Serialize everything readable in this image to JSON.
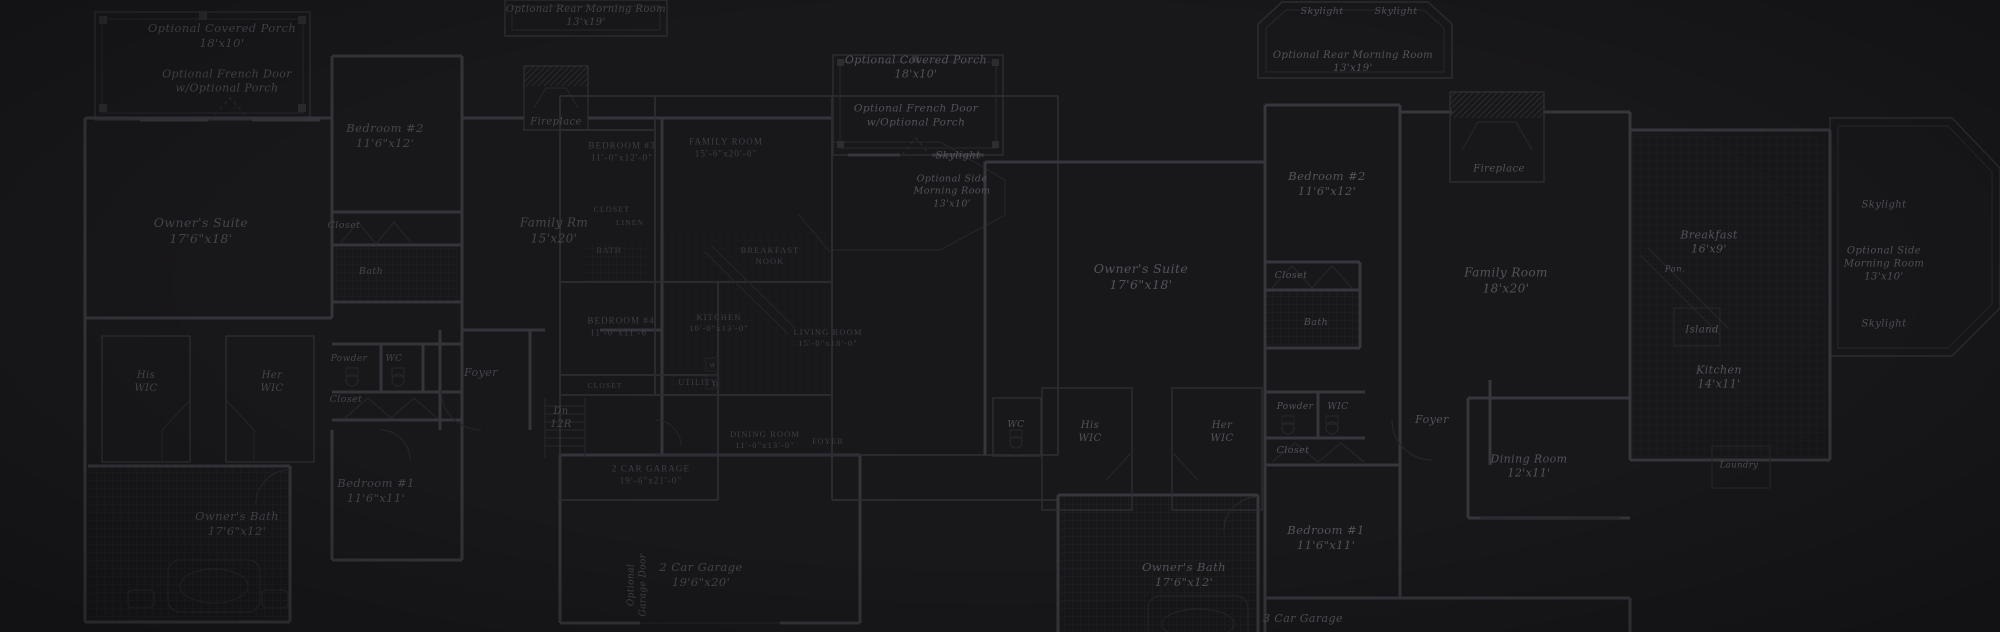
{
  "theme": {
    "background": "#18171a",
    "wall": "#36363c",
    "wall_soft": "#2e2e33",
    "thin": "#26262b",
    "hatch": "#222227",
    "hatch_dim": "#1e1e23",
    "text": "#45454d",
    "text_bright": "#53535c",
    "text_caps": "#3e3e47"
  },
  "description": "Darkened blueprint collage of overlapping residential floor plans",
  "labels": [
    {
      "name": "label-optional-covered-porch-left",
      "plan": "left",
      "style": "i",
      "x": 222,
      "y": 36,
      "size": 11.5,
      "text": "Optional Covered Porch\n18'x10'"
    },
    {
      "name": "label-optional-french-door-left",
      "plan": "left",
      "style": "i",
      "x": 227,
      "y": 82,
      "size": 11,
      "text": "Optional French Door\nw/Optional Porch"
    },
    {
      "name": "label-bedroom-2-left",
      "plan": "left",
      "style": "i",
      "x": 385,
      "y": 136,
      "size": 11.5,
      "text": "Bedroom #2\n11'6\"x12'"
    },
    {
      "name": "label-fireplace-left",
      "plan": "left",
      "style": "i",
      "x": 556,
      "y": 122,
      "size": 10,
      "text": "Fireplace"
    },
    {
      "name": "label-owners-suite-left",
      "plan": "left",
      "style": "i",
      "x": 201,
      "y": 231,
      "size": 12.5,
      "text": "Owner's Suite\n17'6\"x18'"
    },
    {
      "name": "label-closet-bed2-left",
      "plan": "left",
      "style": "i",
      "x": 344,
      "y": 226,
      "size": 9.5,
      "text": "Closet"
    },
    {
      "name": "label-bath-left",
      "plan": "left",
      "style": "i",
      "x": 371,
      "y": 272,
      "size": 9.5,
      "text": "Bath"
    },
    {
      "name": "label-his-wic-left",
      "plan": "left",
      "style": "i",
      "x": 146,
      "y": 382,
      "size": 10,
      "text": "His\nWIC"
    },
    {
      "name": "label-her-wic-left",
      "plan": "left",
      "style": "i",
      "x": 272,
      "y": 382,
      "size": 10,
      "text": "Her\nWIC"
    },
    {
      "name": "label-powder-left",
      "plan": "left",
      "style": "i",
      "x": 349,
      "y": 360,
      "size": 9,
      "text": "Powder"
    },
    {
      "name": "label-wc-left",
      "plan": "left",
      "style": "i",
      "x": 394,
      "y": 360,
      "size": 9,
      "text": "WC"
    },
    {
      "name": "label-closet-hall-left",
      "plan": "left",
      "style": "i",
      "x": 346,
      "y": 400,
      "size": 9.5,
      "text": "Closet"
    },
    {
      "name": "label-foyer-left",
      "plan": "left",
      "style": "i",
      "x": 481,
      "y": 373,
      "size": 11,
      "text": "Foyer"
    },
    {
      "name": "label-family-rm-left",
      "plan": "left",
      "style": "i",
      "x": 554,
      "y": 231,
      "size": 12,
      "text": "Family Rm\n15'x20'"
    },
    {
      "name": "label-stairs-left",
      "plan": "left",
      "style": "i",
      "x": 561,
      "y": 418,
      "size": 10,
      "text": "Dn\n12R"
    },
    {
      "name": "label-bedroom-1-left",
      "plan": "left",
      "style": "i",
      "x": 376,
      "y": 491,
      "size": 11.5,
      "text": "Bedroom #1\n11'6\"x11'"
    },
    {
      "name": "label-owners-bath-left",
      "plan": "left",
      "style": "i",
      "x": 237,
      "y": 524,
      "size": 11.5,
      "text": "Owner's Bath\n17'6\"x12'"
    },
    {
      "name": "label-2-car-garage-left",
      "plan": "left",
      "style": "i",
      "x": 701,
      "y": 575,
      "size": 11.5,
      "text": "2 Car Garage\n19'6\"x20'"
    },
    {
      "name": "label-garage-door-left",
      "plan": "left",
      "style": "v",
      "x": 638,
      "y": 585,
      "size": 9,
      "text": "Optional\nGarage Door"
    },
    {
      "name": "label-skylight-left-bay",
      "plan": "left",
      "style": "ib",
      "x": 958,
      "y": 156,
      "size": 10,
      "text": "Skylight"
    },
    {
      "name": "label-optional-side-morning-room-left",
      "plan": "left",
      "style": "ib",
      "x": 952,
      "y": 192,
      "size": 9.5,
      "text": "Optional Side\nMorning Room\n13'x10'"
    },
    {
      "name": "label-bedroom-3-center",
      "plan": "center",
      "style": "c",
      "x": 622,
      "y": 152,
      "size": 9,
      "text": "BEDROOM #3\n11'-0\"x12'-0\""
    },
    {
      "name": "label-family-room-center",
      "plan": "center",
      "style": "c",
      "x": 726,
      "y": 148,
      "size": 9,
      "text": "FAMILY ROOM\n15'-6\"x20'-0\""
    },
    {
      "name": "label-closet-center-1",
      "plan": "center",
      "style": "c",
      "x": 612,
      "y": 210,
      "size": 8,
      "text": "CLOSET"
    },
    {
      "name": "label-linen-center",
      "plan": "center",
      "style": "c",
      "x": 630,
      "y": 223,
      "size": 7.5,
      "text": "LINEN"
    },
    {
      "name": "label-bath-center",
      "plan": "center",
      "style": "c",
      "x": 609,
      "y": 251,
      "size": 8,
      "text": "BATH"
    },
    {
      "name": "label-breakfast-nook-center",
      "plan": "center",
      "style": "c",
      "x": 770,
      "y": 256,
      "size": 8.5,
      "text": "BREAKFAST\nNOOK"
    },
    {
      "name": "label-bedroom-4-center",
      "plan": "center",
      "style": "c",
      "x": 621,
      "y": 327,
      "size": 9,
      "text": "BEDROOM #4\n11'-0\"x11'-6\""
    },
    {
      "name": "label-kitchen-center",
      "plan": "center",
      "style": "c",
      "x": 719,
      "y": 323,
      "size": 8.5,
      "text": "KITCHEN\n10'-0\"x13'-0\""
    },
    {
      "name": "label-living-room-center",
      "plan": "center",
      "style": "c",
      "x": 828,
      "y": 338,
      "size": 8.5,
      "text": "LIVING ROOM\n15'-0\"x18'-0\""
    },
    {
      "name": "label-closet-center-2",
      "plan": "center",
      "style": "c",
      "x": 605,
      "y": 386,
      "size": 7.5,
      "text": "CLOSET"
    },
    {
      "name": "label-utility-center",
      "plan": "center",
      "style": "c",
      "x": 698,
      "y": 383,
      "size": 8,
      "text": "UTILITY"
    },
    {
      "name": "label-washer-center",
      "plan": "center",
      "style": "c",
      "x": 713,
      "y": 366,
      "size": 7,
      "text": "W"
    },
    {
      "name": "label-dryer-center",
      "plan": "center",
      "style": "c",
      "x": 716,
      "y": 385,
      "size": 7,
      "text": "D"
    },
    {
      "name": "label-dining-room-center",
      "plan": "center",
      "style": "c",
      "x": 765,
      "y": 440,
      "size": 8.5,
      "text": "DINING ROOM\n11'-0\"x13'-0\""
    },
    {
      "name": "label-foyer-center",
      "plan": "center",
      "style": "c",
      "x": 828,
      "y": 442,
      "size": 8,
      "text": "FOYER"
    },
    {
      "name": "label-2-car-garage-center",
      "plan": "center",
      "style": "c",
      "x": 651,
      "y": 475,
      "size": 9,
      "text": "2 CAR GARAGE\n19'-6\"x21'-0\""
    },
    {
      "name": "label-optional-rear-morning-room-top-center",
      "plan": "top",
      "style": "i",
      "x": 586,
      "y": 16,
      "size": 10,
      "text": "Optional Rear Morning Room\n13'x19'"
    },
    {
      "name": "label-skylight-top-right-1",
      "plan": "top",
      "style": "ib",
      "x": 1322,
      "y": 12,
      "size": 9.5,
      "text": "Skylight"
    },
    {
      "name": "label-skylight-top-right-2",
      "plan": "top",
      "style": "ib",
      "x": 1396,
      "y": 12,
      "size": 9.5,
      "text": "Skylight"
    },
    {
      "name": "label-optional-rear-morning-room-top-right",
      "plan": "top",
      "style": "ib",
      "x": 1353,
      "y": 62,
      "size": 10,
      "text": "Optional Rear Morning Room\n13'x19'"
    },
    {
      "name": "label-optional-covered-porch-right",
      "plan": "right",
      "style": "ib",
      "x": 916,
      "y": 68,
      "size": 11,
      "text": "Optional Covered Porch\n18'x10'"
    },
    {
      "name": "label-optional-french-door-right",
      "plan": "right",
      "style": "ib",
      "x": 916,
      "y": 116,
      "size": 10.5,
      "text": "Optional French Door\nw/Optional Porch"
    },
    {
      "name": "label-bedroom-2-right",
      "plan": "right",
      "style": "ib",
      "x": 1327,
      "y": 184,
      "size": 11.5,
      "text": "Bedroom #2\n11'6\"x12'"
    },
    {
      "name": "label-fireplace-right",
      "plan": "right",
      "style": "ib",
      "x": 1499,
      "y": 169,
      "size": 10,
      "text": "Fireplace"
    },
    {
      "name": "label-owners-suite-right",
      "plan": "right",
      "style": "ib",
      "x": 1141,
      "y": 277,
      "size": 12.5,
      "text": "Owner's Suite\n17'6\"x18'"
    },
    {
      "name": "label-closet-bed2-right",
      "plan": "right",
      "style": "ib",
      "x": 1291,
      "y": 276,
      "size": 9.5,
      "text": "Closet"
    },
    {
      "name": "label-bath-right",
      "plan": "right",
      "style": "ib",
      "x": 1316,
      "y": 323,
      "size": 9.5,
      "text": "Bath"
    },
    {
      "name": "label-wc-room-right",
      "plan": "right",
      "style": "ib",
      "x": 1016,
      "y": 426,
      "size": 9,
      "text": "WC"
    },
    {
      "name": "label-his-wic-right",
      "plan": "right",
      "style": "ib",
      "x": 1090,
      "y": 432,
      "size": 10,
      "text": "His\nWIC"
    },
    {
      "name": "label-her-wic-right",
      "plan": "right",
      "style": "ib",
      "x": 1222,
      "y": 432,
      "size": 10,
      "text": "Her\nWIC"
    },
    {
      "name": "label-powder-right",
      "plan": "right",
      "style": "ib",
      "x": 1295,
      "y": 408,
      "size": 9,
      "text": "Powder"
    },
    {
      "name": "label-wic-right",
      "plan": "right",
      "style": "ib",
      "x": 1338,
      "y": 408,
      "size": 9,
      "text": "WIC"
    },
    {
      "name": "label-closet-hall-right",
      "plan": "right",
      "style": "ib",
      "x": 1293,
      "y": 451,
      "size": 9.5,
      "text": "Closet"
    },
    {
      "name": "label-foyer-right",
      "plan": "right",
      "style": "ib",
      "x": 1432,
      "y": 420,
      "size": 11,
      "text": "Foyer"
    },
    {
      "name": "label-family-room-right",
      "plan": "right",
      "style": "ib",
      "x": 1506,
      "y": 281,
      "size": 12,
      "text": "Family Room\n18'x20'"
    },
    {
      "name": "label-breakfast-right",
      "plan": "right",
      "style": "ib",
      "x": 1709,
      "y": 243,
      "size": 11,
      "text": "Breakfast\n16'x9'"
    },
    {
      "name": "label-pantry-right",
      "plan": "right",
      "style": "ib",
      "x": 1675,
      "y": 270,
      "size": 8.5,
      "text": "Pan."
    },
    {
      "name": "label-island-right",
      "plan": "right",
      "style": "ib",
      "x": 1702,
      "y": 330,
      "size": 10,
      "text": "Island"
    },
    {
      "name": "label-kitchen-right",
      "plan": "right",
      "style": "ib",
      "x": 1719,
      "y": 378,
      "size": 11,
      "text": "Kitchen\n14'x11'"
    },
    {
      "name": "label-laundry-right",
      "plan": "right",
      "style": "ib",
      "x": 1739,
      "y": 466,
      "size": 8.5,
      "text": "Laundry"
    },
    {
      "name": "label-dining-room-right",
      "plan": "right",
      "style": "ib",
      "x": 1529,
      "y": 467,
      "size": 11,
      "text": "Dining Room\n12'x11'"
    },
    {
      "name": "label-bedroom-1-right",
      "plan": "right",
      "style": "ib",
      "x": 1326,
      "y": 538,
      "size": 11.5,
      "text": "Bedroom #1\n11'6\"x11'"
    },
    {
      "name": "label-owners-bath-right",
      "plan": "right",
      "style": "ib",
      "x": 1184,
      "y": 575,
      "size": 11.5,
      "text": "Owner's Bath\n17'6\"x12'"
    },
    {
      "name": "label-3-car-garage-right",
      "plan": "right",
      "style": "ib",
      "x": 1303,
      "y": 619,
      "size": 11,
      "text": "3 Car Garage"
    },
    {
      "name": "label-skylight-right-bay-1",
      "plan": "right",
      "style": "ib",
      "x": 1884,
      "y": 205,
      "size": 10,
      "text": "Skylight"
    },
    {
      "name": "label-optional-side-morning-room-right",
      "plan": "right",
      "style": "ib",
      "x": 1884,
      "y": 264,
      "size": 10,
      "text": "Optional Side\nMorning Room\n13'x10'"
    },
    {
      "name": "label-skylight-right-bay-2",
      "plan": "right",
      "style": "ib",
      "x": 1884,
      "y": 324,
      "size": 10,
      "text": "Skylight"
    }
  ]
}
